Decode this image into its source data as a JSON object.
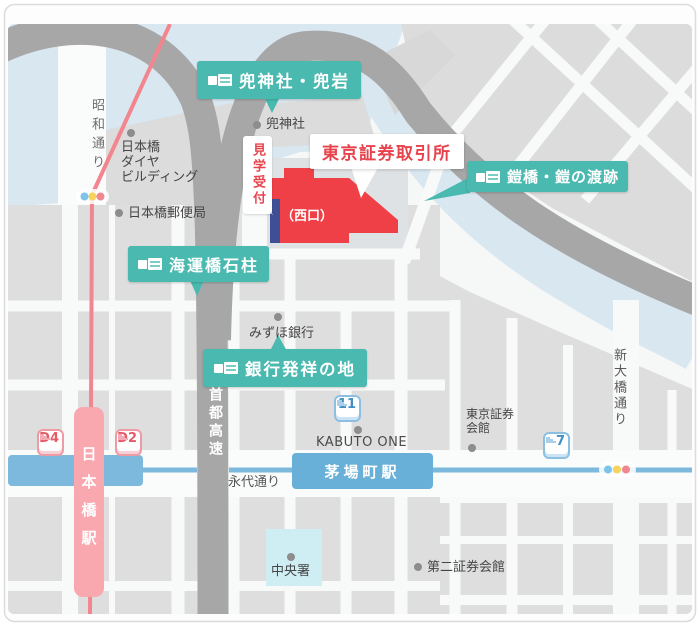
{
  "labels": {
    "main_title": "東京証券取引所",
    "visitor_reception": "見学受付",
    "west_exit": "（西口）",
    "spots": [
      {
        "text": "兜神社・兜岩"
      },
      {
        "text": "鎧橋・鎧の渡跡"
      },
      {
        "text": "海運橋石柱"
      },
      {
        "text": "銀行発祥の地"
      }
    ]
  },
  "pois": {
    "kabuto_shrine": "兜神社",
    "daiya_building_lines": [
      "日本橋",
      "ダイヤ",
      "ビルディング"
    ],
    "post_office": "日本橋郵便局",
    "mizuho_bank": "みずほ銀行",
    "kabuto_one": "KABUTO ONE",
    "shoken_kaikan_lines": [
      "東京証券",
      "会館"
    ],
    "daini_shoken_kaikan": "第二証券会館",
    "chuo_police": "中央署"
  },
  "roads": {
    "showa_dori": "昭和通り",
    "shuto_expressway": "首都高速",
    "eitai_dori": "永代通り",
    "shin_ohashi_dori": "新大橋通り"
  },
  "stations": {
    "nihombashi": "日本橋駅",
    "kayabacho": "茅場町駅"
  },
  "exits": {
    "d4": "D4",
    "d2": "D2",
    "no11": "11",
    "no7": "7"
  },
  "colors": {
    "spot_label_teal": "#4ab9af",
    "tse_red": "#ee4046",
    "entrance_navy": "#3f4f95",
    "station_pink": "#f9a8b0",
    "rail_pink": "#f2858d",
    "subway_blue": "#7cb9dd",
    "kayabacho_blue": "#68b0d8",
    "water_blue": "#d9e7f1",
    "expressway_gray": "#a7a7a7",
    "block_gray": "#dedede",
    "police_cyan": "#cfeef3"
  }
}
